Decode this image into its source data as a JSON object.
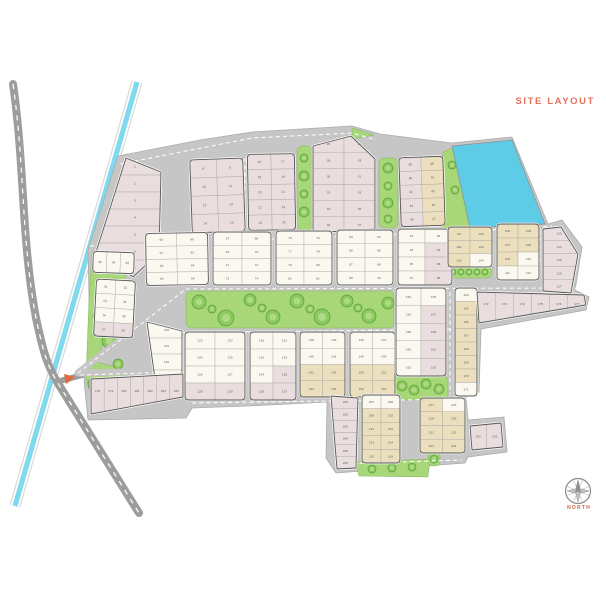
{
  "site": {
    "title": "SITE LAYOUT",
    "title_color": "#e4715c"
  },
  "compass": {
    "label": "NORTH",
    "label_color": "#cf604b"
  },
  "palette": {
    "background": "#ffffff",
    "road_main": "#9d9d9d",
    "road_inner": "#c6c6c6",
    "road_edge": "#ababab",
    "road_dash": "#ffffff",
    "canal": "#80d9ee",
    "pond": "#5ecbe7",
    "green": "#a7d778",
    "green_edge": "#85b35d",
    "tree": "#8cc95f",
    "tree_edge": "#599c38",
    "tree_inner": "#b2dd8b",
    "plot_white": "#fbf8ef",
    "plot_pink": "#e9dddd",
    "plot_tan": "#ebdfbd",
    "block_border": "#565656",
    "cell_line": "#a0a0a0",
    "number_color": "#5d5d5d",
    "entrance": "#e06a3d",
    "compass_gray": "#8a8a8a"
  },
  "blocks": [
    {
      "id": "A1",
      "numbers": [
        1,
        2,
        3,
        4,
        5,
        6,
        7
      ],
      "cell_colors": "ppppppp"
    },
    {
      "id": "A2",
      "numbers": [
        8,
        9,
        10,
        11,
        12,
        13,
        14,
        15
      ],
      "cell_colors": "pppppppp"
    },
    {
      "id": "A3",
      "numbers": [
        16,
        17,
        18,
        19,
        20,
        21,
        22,
        23,
        24,
        25
      ],
      "cell_colors": "pppppppppp"
    },
    {
      "id": "A4",
      "numbers": [
        26,
        27,
        28,
        29,
        30,
        31,
        32,
        33,
        34,
        35,
        36,
        37
      ],
      "cell_colors": "pppppppppppp"
    },
    {
      "id": "A5",
      "numbers": [
        38,
        39,
        40,
        41,
        42,
        43,
        44,
        45,
        46,
        47
      ],
      "cell_colors": "ptptptptpt"
    },
    {
      "id": "B1a",
      "numbers": [
        48,
        49,
        50
      ],
      "cell_colors": "www"
    },
    {
      "id": "B1b",
      "numbers": [
        51,
        52,
        53,
        54,
        55,
        56,
        57,
        58
      ],
      "cell_colors": "wwwwwwpp"
    },
    {
      "id": "B2",
      "numbers": [
        59,
        60,
        61,
        62,
        63,
        64,
        65,
        66
      ],
      "cell_colors": "wwwwwwww"
    },
    {
      "id": "B3",
      "numbers": [
        67,
        68,
        69,
        70,
        71,
        72,
        73,
        74
      ],
      "cell_colors": "wwwwwwww"
    },
    {
      "id": "B4",
      "numbers": [
        75,
        76,
        77,
        78,
        79,
        80,
        81,
        82
      ],
      "cell_colors": "wwwwwwww"
    },
    {
      "id": "B5",
      "numbers": [
        83,
        84,
        85,
        86,
        87,
        88,
        89,
        90
      ],
      "cell_colors": "wwwwwwww"
    },
    {
      "id": "B6",
      "numbers": [
        91,
        92,
        93,
        94,
        95,
        96,
        97,
        98
      ],
      "cell_colors": "wwwpwpwp"
    },
    {
      "id": "T1",
      "numbers": [
        99,
        100,
        101,
        102,
        103,
        104
      ],
      "cell_colors": "tttttw"
    },
    {
      "id": "T2",
      "numbers": [
        105,
        106,
        107,
        108,
        109,
        110,
        111,
        112
      ],
      "cell_colors": "tttttwww"
    },
    {
      "id": "T3",
      "numbers": [
        113,
        114,
        115,
        116,
        117
      ],
      "cell_colors": "ppppp"
    },
    {
      "id": "C0",
      "numbers": [
        118,
        119,
        120,
        121
      ],
      "cell_colors": "wwww"
    },
    {
      "id": "C1",
      "numbers": [
        122,
        123,
        124,
        125,
        126,
        127,
        128,
        129
      ],
      "cell_colors": "wwwwwwpp"
    },
    {
      "id": "C2",
      "numbers": [
        130,
        131,
        132,
        133,
        134,
        135,
        136,
        137
      ],
      "cell_colors": "wwwwwppp"
    },
    {
      "id": "C3",
      "numbers": [
        138,
        139,
        140,
        141,
        142,
        143,
        144,
        145
      ],
      "cell_colors": "wwwwtttt"
    },
    {
      "id": "C4",
      "numbers": [
        146,
        147,
        148,
        149,
        150,
        151,
        152,
        153
      ],
      "cell_colors": "wwwwtttt"
    },
    {
      "id": "C5",
      "numbers": [
        154,
        155,
        156,
        157,
        158,
        159,
        160,
        161,
        162,
        163
      ],
      "cell_colors": "wwwpwpwpwp"
    },
    {
      "id": "C6",
      "numbers": [
        164,
        165,
        166,
        167,
        168,
        169,
        170,
        171
      ],
      "cell_colors": "wttttttw"
    },
    {
      "id": "C7",
      "numbers": [
        172,
        173,
        174,
        175,
        176,
        177
      ],
      "cell_colors": "pppppp"
    },
    {
      "id": "PS",
      "numbers": [
        178,
        179,
        180,
        181,
        182,
        183,
        184
      ],
      "cell_colors": "ppppppp"
    },
    {
      "id": "D1",
      "numbers": [
        201,
        202,
        203,
        204,
        205,
        206
      ],
      "cell_colors": "pppppp"
    },
    {
      "id": "D2",
      "numbers": [
        207,
        208,
        209,
        210,
        211,
        212,
        213,
        214,
        215,
        216
      ],
      "cell_colors": "wwtttttttt"
    },
    {
      "id": "D3",
      "numbers": [
        217,
        218,
        219,
        220,
        221,
        222,
        223,
        224
      ],
      "cell_colors": "twtttttt"
    },
    {
      "id": "D4",
      "numbers": [
        225,
        226
      ],
      "cell_colors": "pp"
    }
  ]
}
